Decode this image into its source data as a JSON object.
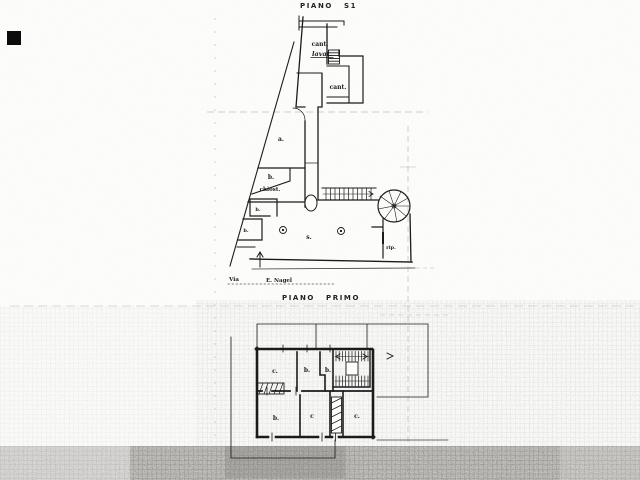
{
  "plans": {
    "s1": {
      "title": "PIANO S1",
      "rooms": {
        "cant_top": "cant.",
        "lavat": "lavat.",
        "cant_right": "cant.",
        "room_a": "a.",
        "room_b": "b.",
        "chiost": "chiost.",
        "room_left_1": "b.",
        "room_left_2": "b.",
        "hall": "s.",
        "rip": "rip."
      },
      "street": {
        "word1": "Via",
        "word2": "E. Nagel"
      }
    },
    "primo": {
      "title": "PIANO PRIMO",
      "rooms": {
        "up_1": "c.",
        "up_2": "b.",
        "up_3": "b.",
        "low_1": "b.",
        "low_2": "c",
        "low_3": "c."
      }
    }
  },
  "colors": {
    "ink": "#1b1b1b",
    "paper": "#fdfdfc",
    "scan_band_gray": "#c6c4c0"
  }
}
